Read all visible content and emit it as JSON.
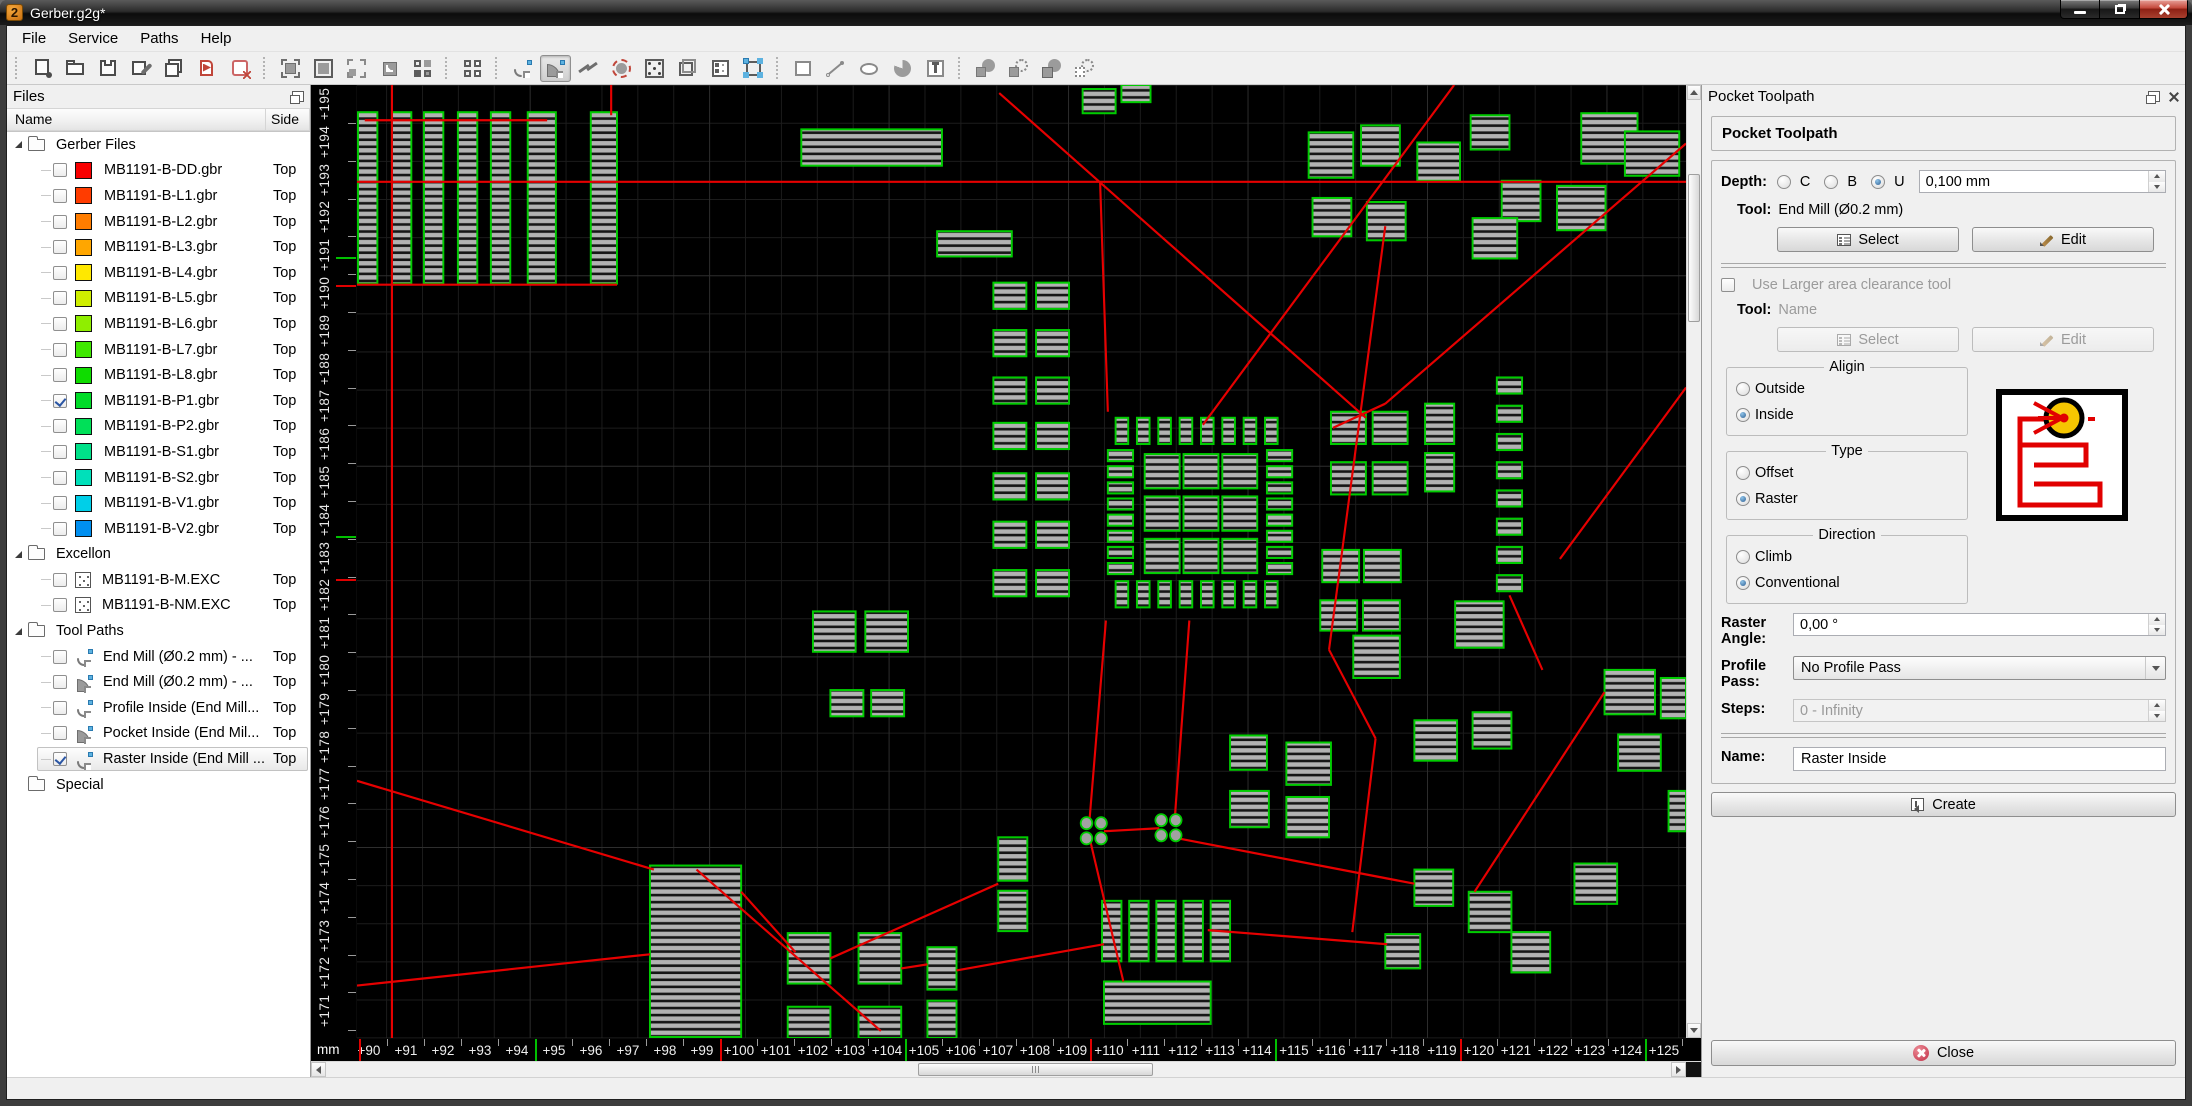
{
  "window": {
    "title": "Gerber.g2g*",
    "logo_glyph": "2"
  },
  "menu": {
    "items": [
      "File",
      "Service",
      "Paths",
      "Help"
    ]
  },
  "toolbar": {
    "groups": [
      {
        "items": [
          "new-document",
          "open",
          "save",
          "save-as",
          "save-all",
          "import-paths",
          "close-file"
        ]
      },
      {
        "items": [
          "zoom-fit",
          "zoom-selection",
          "zoom-out-selection",
          "zoom-in-selection",
          "view-pads"
        ]
      },
      {
        "items": [
          "view-grid"
        ]
      },
      {
        "items": [
          "arc-tool",
          "arc-filled-tool",
          "polyline-tool",
          "restring-tool",
          "pad-tool",
          "outline-tool",
          "properties-form",
          "transform-tool"
        ]
      },
      {
        "items": [
          "draw-rectangle",
          "draw-line",
          "draw-ellipse",
          "draw-pie",
          "draw-text"
        ]
      },
      {
        "items": [
          "bool-union",
          "bool-subtract",
          "bool-intersect",
          "bool-exclude"
        ]
      }
    ],
    "pressed": "arc-filled-tool"
  },
  "files_panel": {
    "title": "Files",
    "columns": {
      "name": "Name",
      "side": "Side"
    },
    "rows": [
      {
        "kind": "folder",
        "label": "Gerber Files",
        "expanded": true
      },
      {
        "kind": "layer",
        "label": "MB1191-B-DD.gbr",
        "color": "#f80000",
        "checked": false,
        "side": "Top"
      },
      {
        "kind": "layer",
        "label": "MB1191-B-L1.gbr",
        "color": "#ff3c00",
        "checked": false,
        "side": "Top"
      },
      {
        "kind": "layer",
        "label": "MB1191-B-L2.gbr",
        "color": "#ff7d00",
        "checked": false,
        "side": "Top"
      },
      {
        "kind": "layer",
        "label": "MB1191-B-L3.gbr",
        "color": "#ffa600",
        "checked": false,
        "side": "Top"
      },
      {
        "kind": "layer",
        "label": "MB1191-B-L4.gbr",
        "color": "#ffe800",
        "checked": false,
        "side": "Top"
      },
      {
        "kind": "layer",
        "label": "MB1191-B-L5.gbr",
        "color": "#cfee00",
        "checked": false,
        "side": "Top"
      },
      {
        "kind": "layer",
        "label": "MB1191-B-L6.gbr",
        "color": "#8fee00",
        "checked": false,
        "side": "Top"
      },
      {
        "kind": "layer",
        "label": "MB1191-B-L7.gbr",
        "color": "#3fe800",
        "checked": false,
        "side": "Top"
      },
      {
        "kind": "layer",
        "label": "MB1191-B-L8.gbr",
        "color": "#0fdc00",
        "checked": false,
        "side": "Top"
      },
      {
        "kind": "layer",
        "label": "MB1191-B-P1.gbr",
        "color": "#00dc28",
        "checked": true,
        "side": "Top"
      },
      {
        "kind": "layer",
        "label": "MB1191-B-P2.gbr",
        "color": "#00e058",
        "checked": false,
        "side": "Top"
      },
      {
        "kind": "layer",
        "label": "MB1191-B-S1.gbr",
        "color": "#00e189",
        "checked": false,
        "side": "Top"
      },
      {
        "kind": "layer",
        "label": "MB1191-B-S2.gbr",
        "color": "#00e0ba",
        "checked": false,
        "side": "Top"
      },
      {
        "kind": "layer",
        "label": "MB1191-B-V1.gbr",
        "color": "#00cfe8",
        "checked": false,
        "side": "Top"
      },
      {
        "kind": "layer",
        "label": "MB1191-B-V2.gbr",
        "color": "#008ff0",
        "checked": false,
        "side": "Top"
      },
      {
        "kind": "folder",
        "label": "Excellon",
        "expanded": true
      },
      {
        "kind": "drill",
        "label": "MB1191-B-M.EXC",
        "checked": false,
        "side": "Top"
      },
      {
        "kind": "drill",
        "label": "MB1191-B-NM.EXC",
        "checked": false,
        "side": "Top"
      },
      {
        "kind": "folder",
        "label": "Tool Paths",
        "expanded": true
      },
      {
        "kind": "path",
        "icon": "arc",
        "label": "End Mill (Ø0.2 mm) - ...",
        "checked": false,
        "side": "Top"
      },
      {
        "kind": "path",
        "icon": "arcfill",
        "label": "End Mill (Ø0.2 mm) - ...",
        "checked": false,
        "side": "Top"
      },
      {
        "kind": "path",
        "icon": "arc",
        "label": "Profile Inside (End Mill...",
        "checked": false,
        "side": "Top"
      },
      {
        "kind": "path",
        "icon": "arcfill",
        "label": "Pocket Inside (End Mil...",
        "checked": false,
        "side": "Top"
      },
      {
        "kind": "path",
        "icon": "arc",
        "label": "Raster Inside (End Mill ...",
        "checked": true,
        "selected": true,
        "side": "Top"
      },
      {
        "kind": "folder",
        "label": "Special",
        "expanded": false
      }
    ]
  },
  "pocket_panel": {
    "title": "Pocket Toolpath",
    "heading": "Pocket Toolpath",
    "depth": {
      "label": "Depth:",
      "options": [
        "C",
        "B",
        "U"
      ],
      "selected": "U",
      "value": "0,100 mm"
    },
    "tool": {
      "label": "Tool:",
      "value": "End Mill (Ø0.2 mm)",
      "select_label": "Select",
      "edit_label": "Edit"
    },
    "clearance": {
      "checkbox_label": "Use Larger area clearance tool",
      "tool_label": "Tool:",
      "tool_value": "Name",
      "select_label": "Select",
      "edit_label": "Edit"
    },
    "align": {
      "title": "Aligin",
      "options": [
        "Outside",
        "Inside"
      ],
      "selected": "Inside"
    },
    "type": {
      "title": "Type",
      "options": [
        "Offset",
        "Raster"
      ],
      "selected": "Raster"
    },
    "direction": {
      "title": "Direction",
      "options": [
        "Climb",
        "Conventional"
      ],
      "selected": "Conventional"
    },
    "raster_angle": {
      "label": "Raster Angle:",
      "value": "0,00 °"
    },
    "profile_pass": {
      "label": "Profile Pass:",
      "value": "No Profile Pass"
    },
    "steps": {
      "label": "Steps:",
      "value": "0 - Infinity"
    },
    "name": {
      "label": "Name:",
      "value": "Raster Inside"
    },
    "create_label": "Create",
    "close_label": "Close"
  },
  "rulers": {
    "unit": "mm",
    "h_labels": [
      "+90",
      "+91",
      "+92",
      "+93",
      "+94",
      "+95",
      "+96",
      "+97",
      "+98",
      "+99",
      "+100",
      "+101",
      "+102",
      "+103",
      "+104",
      "+105",
      "+106",
      "+107",
      "+108",
      "+109",
      "+110",
      "+111",
      "+112",
      "+113",
      "+114",
      "+115",
      "+116",
      "+117",
      "+118",
      "+119",
      "+120",
      "+121",
      "+122",
      "+123",
      "+124",
      "+125",
      "+126"
    ],
    "v_labels": [
      "+195",
      "+194",
      "+193",
      "+192",
      "+191",
      "+190",
      "+189",
      "+188",
      "+187",
      "+186",
      "+185",
      "+184",
      "+183",
      "+182",
      "+181",
      "+180",
      "+179",
      "+178",
      "+177",
      "+176",
      "+175",
      "+174",
      "+173",
      "+172",
      "+171"
    ],
    "h_marks": [
      {
        "x": 2,
        "c": "#e00000"
      },
      {
        "x": 178,
        "c": "#00c000"
      },
      {
        "x": 363,
        "c": "#e00000"
      },
      {
        "x": 548,
        "c": "#00c000"
      },
      {
        "x": 733,
        "c": "#e00000"
      },
      {
        "x": 918,
        "c": "#00c000"
      },
      {
        "x": 1103,
        "c": "#e00000"
      },
      {
        "x": 1288,
        "c": "#00c000"
      }
    ],
    "v_marks": [
      {
        "y": 172,
        "c": "#00c000"
      },
      {
        "y": 200,
        "c": "#e00000"
      },
      {
        "y": 451,
        "c": "#00c000"
      },
      {
        "y": 494,
        "c": "#e00000"
      }
    ]
  },
  "canvas": {
    "width": 1370,
    "height": 945,
    "background": "#000000",
    "grid_minor": "#1c1c1c",
    "grid_major": "#2e2e2e",
    "grid_step_x": 37,
    "grid_step_y": 37.8,
    "pad_fill": "#b2b2b2",
    "pad_stroke": "#00cc00",
    "ratsnest": "#e60000",
    "pads": [
      [
        -22,
        27,
        12,
        170
      ],
      [
        1,
        27,
        20,
        170
      ],
      [
        36,
        27,
        20,
        170
      ],
      [
        69,
        27,
        20,
        170
      ],
      [
        104,
        27,
        20,
        170
      ],
      [
        138,
        27,
        20,
        170
      ],
      [
        176,
        27,
        29,
        170
      ],
      [
        241,
        27,
        27,
        170
      ],
      [
        458,
        44,
        145,
        36
      ],
      [
        598,
        145,
        77,
        25
      ],
      [
        748,
        4,
        34,
        24
      ],
      [
        788,
        0,
        30,
        17
      ],
      [
        981,
        47,
        46,
        45
      ],
      [
        1035,
        40,
        40,
        40
      ],
      [
        1093,
        57,
        44,
        38
      ],
      [
        1148,
        30,
        40,
        34
      ],
      [
        1262,
        28,
        58,
        50
      ],
      [
        1180,
        95,
        40,
        40
      ],
      [
        1237,
        100,
        50,
        44
      ],
      [
        985,
        112,
        40,
        38
      ],
      [
        1041,
        116,
        40,
        38
      ],
      [
        1150,
        132,
        46,
        40
      ],
      [
        1307,
        46,
        56,
        44
      ],
      [
        1004,
        324,
        36,
        32
      ],
      [
        1047,
        324,
        36,
        32
      ],
      [
        1101,
        316,
        30,
        40
      ],
      [
        1004,
        374,
        36,
        32
      ],
      [
        1047,
        374,
        36,
        32
      ],
      [
        1101,
        365,
        30,
        38
      ],
      [
        995,
        461,
        38,
        32
      ],
      [
        1038,
        461,
        38,
        32
      ],
      [
        993,
        511,
        38,
        30
      ],
      [
        1037,
        511,
        38,
        30
      ],
      [
        470,
        522,
        44,
        40
      ],
      [
        524,
        522,
        44,
        40
      ],
      [
        488,
        600,
        34,
        26
      ],
      [
        530,
        600,
        34,
        26
      ],
      [
        661,
        746,
        30,
        43
      ],
      [
        661,
        799,
        30,
        40
      ],
      [
        302,
        774,
        94,
        170
      ],
      [
        444,
        841,
        44,
        50
      ],
      [
        517,
        841,
        44,
        50
      ],
      [
        444,
        914,
        44,
        31
      ],
      [
        517,
        914,
        44,
        31
      ],
      [
        588,
        855,
        30,
        42
      ],
      [
        588,
        908,
        30,
        37
      ],
      [
        770,
        889,
        110,
        42
      ],
      [
        1027,
        546,
        48,
        42
      ],
      [
        1132,
        512,
        50,
        46
      ],
      [
        1090,
        630,
        44,
        40
      ],
      [
        1150,
        622,
        40,
        36
      ],
      [
        900,
        645,
        38,
        34
      ],
      [
        958,
        652,
        46,
        42
      ],
      [
        1286,
        580,
        52,
        44
      ],
      [
        1344,
        588,
        26,
        40
      ],
      [
        1300,
        644,
        44,
        36
      ],
      [
        1352,
        700,
        18,
        40
      ],
      [
        1090,
        778,
        40,
        36
      ],
      [
        1146,
        800,
        44,
        40
      ],
      [
        1060,
        842,
        36,
        34
      ],
      [
        1190,
        840,
        40,
        40
      ],
      [
        1255,
        772,
        44,
        40
      ],
      [
        900,
        700,
        40,
        36
      ],
      [
        958,
        706,
        44,
        40
      ]
    ],
    "generated": [
      {
        "kind": "row",
        "x": 782,
        "y": 330,
        "count": 8,
        "dx": 22,
        "w": 13,
        "h": 26
      },
      {
        "kind": "row",
        "x": 782,
        "y": 492,
        "count": 8,
        "dx": 22,
        "w": 13,
        "h": 26
      },
      {
        "kind": "col",
        "x": 774,
        "y": 362,
        "count": 8,
        "dy": 16,
        "w": 26,
        "h": 11
      },
      {
        "kind": "col",
        "x": 938,
        "y": 362,
        "count": 8,
        "dy": 16,
        "w": 26,
        "h": 11
      },
      {
        "kind": "grid",
        "x": 812,
        "y": 366,
        "cols": 3,
        "rows": 3,
        "dx": 40,
        "dy": 42,
        "w": 36,
        "h": 34
      },
      {
        "kind": "pairs",
        "x1": 656,
        "x2": 700,
        "w": 34,
        "h": 26,
        "ys": [
          196,
          243,
          290,
          335,
          385,
          433,
          481
        ]
      },
      {
        "kind": "col",
        "x": 1175,
        "y": 290,
        "count": 8,
        "dy": 28,
        "w": 26,
        "h": 16
      },
      {
        "kind": "row",
        "x": 768,
        "y": 809,
        "count": 5,
        "dx": 28,
        "w": 20,
        "h": 60
      }
    ],
    "vias": [
      [
        752,
        732
      ],
      [
        767,
        732
      ],
      [
        752,
        747
      ],
      [
        767,
        747
      ],
      [
        829,
        729
      ],
      [
        844,
        729
      ],
      [
        829,
        744
      ],
      [
        844,
        744
      ]
    ],
    "redlines": [
      [
        36,
        0,
        36,
        945
      ],
      [
        0,
        96,
        1370,
        96
      ],
      [
        8,
        35,
        196,
        35
      ],
      [
        0,
        198,
        268,
        198
      ],
      [
        262,
        0,
        262,
        30
      ],
      [
        662,
        8,
        1040,
        330
      ],
      [
        1131,
        0,
        872,
        337
      ],
      [
        1370,
        58,
        1060,
        316
      ],
      [
        1060,
        316,
        1006,
        340
      ],
      [
        766,
        96,
        774,
        324
      ],
      [
        772,
        531,
        755,
        730
      ],
      [
        858,
        531,
        843,
        727
      ],
      [
        846,
        747,
        1090,
        792
      ],
      [
        770,
        740,
        827,
        737
      ],
      [
        756,
        750,
        790,
        889
      ],
      [
        0,
        690,
        306,
        778
      ],
      [
        0,
        893,
        302,
        862
      ],
      [
        350,
        778,
        540,
        938
      ],
      [
        396,
        800,
        452,
        860
      ],
      [
        488,
        866,
        661,
        792
      ],
      [
        561,
        876,
        588,
        872
      ],
      [
        618,
        878,
        770,
        852
      ],
      [
        877,
        838,
        1062,
        852
      ],
      [
        1060,
        140,
        1002,
        560
      ],
      [
        1002,
        560,
        1050,
        648
      ],
      [
        1050,
        648,
        1026,
        840
      ],
      [
        1188,
        506,
        1222,
        580
      ],
      [
        1286,
        602,
        1152,
        800
      ],
      [
        1370,
        300,
        1240,
        470
      ]
    ]
  }
}
